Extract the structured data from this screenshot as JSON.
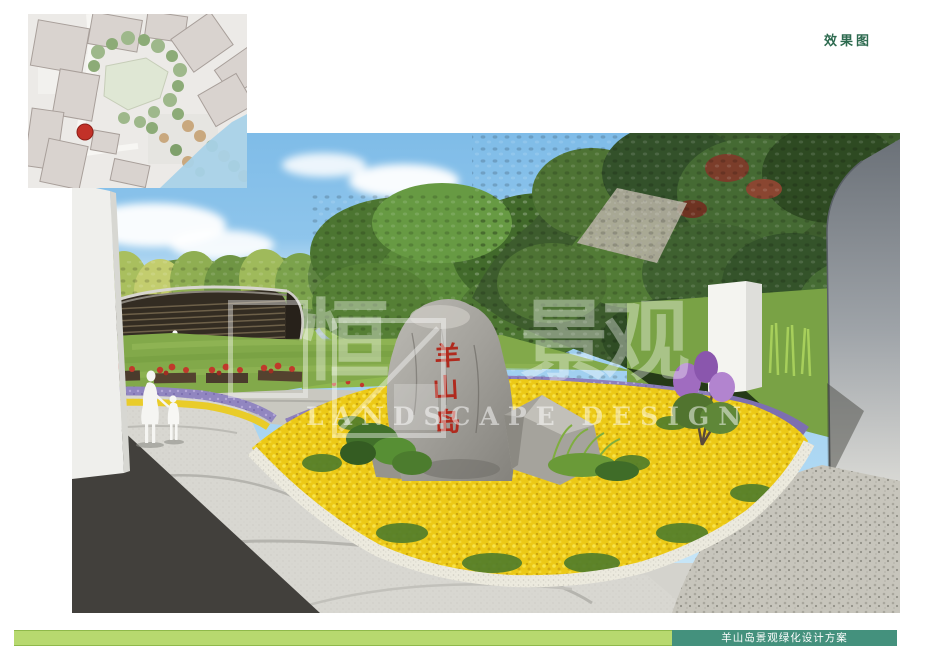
{
  "header": {
    "label": "效果图"
  },
  "footer": {
    "title": "羊山岛景观绿化设计方案",
    "bar_light_color": "#b7d96f",
    "bar_teal_color": "#44917d"
  },
  "site_plan": {
    "marker_color": "#c23128",
    "water_color": "#a9d2e8"
  },
  "rendering": {
    "stone_inscription": "羊山岛",
    "stone_chars": [
      "羊",
      "山",
      "岛"
    ],
    "inscription_color": "#b02a1e",
    "watermark": {
      "cn_chars": [
        "恒",
        "景",
        "观"
      ],
      "en": "LANDSCAPE DESIGN"
    }
  },
  "colors": {
    "header_text": "#2d6a4f",
    "flower_yellow": "#ecc916",
    "flower_purple": "#8d7fbc",
    "flower_red": "#c0392b",
    "sky": "#8fc4ec"
  }
}
